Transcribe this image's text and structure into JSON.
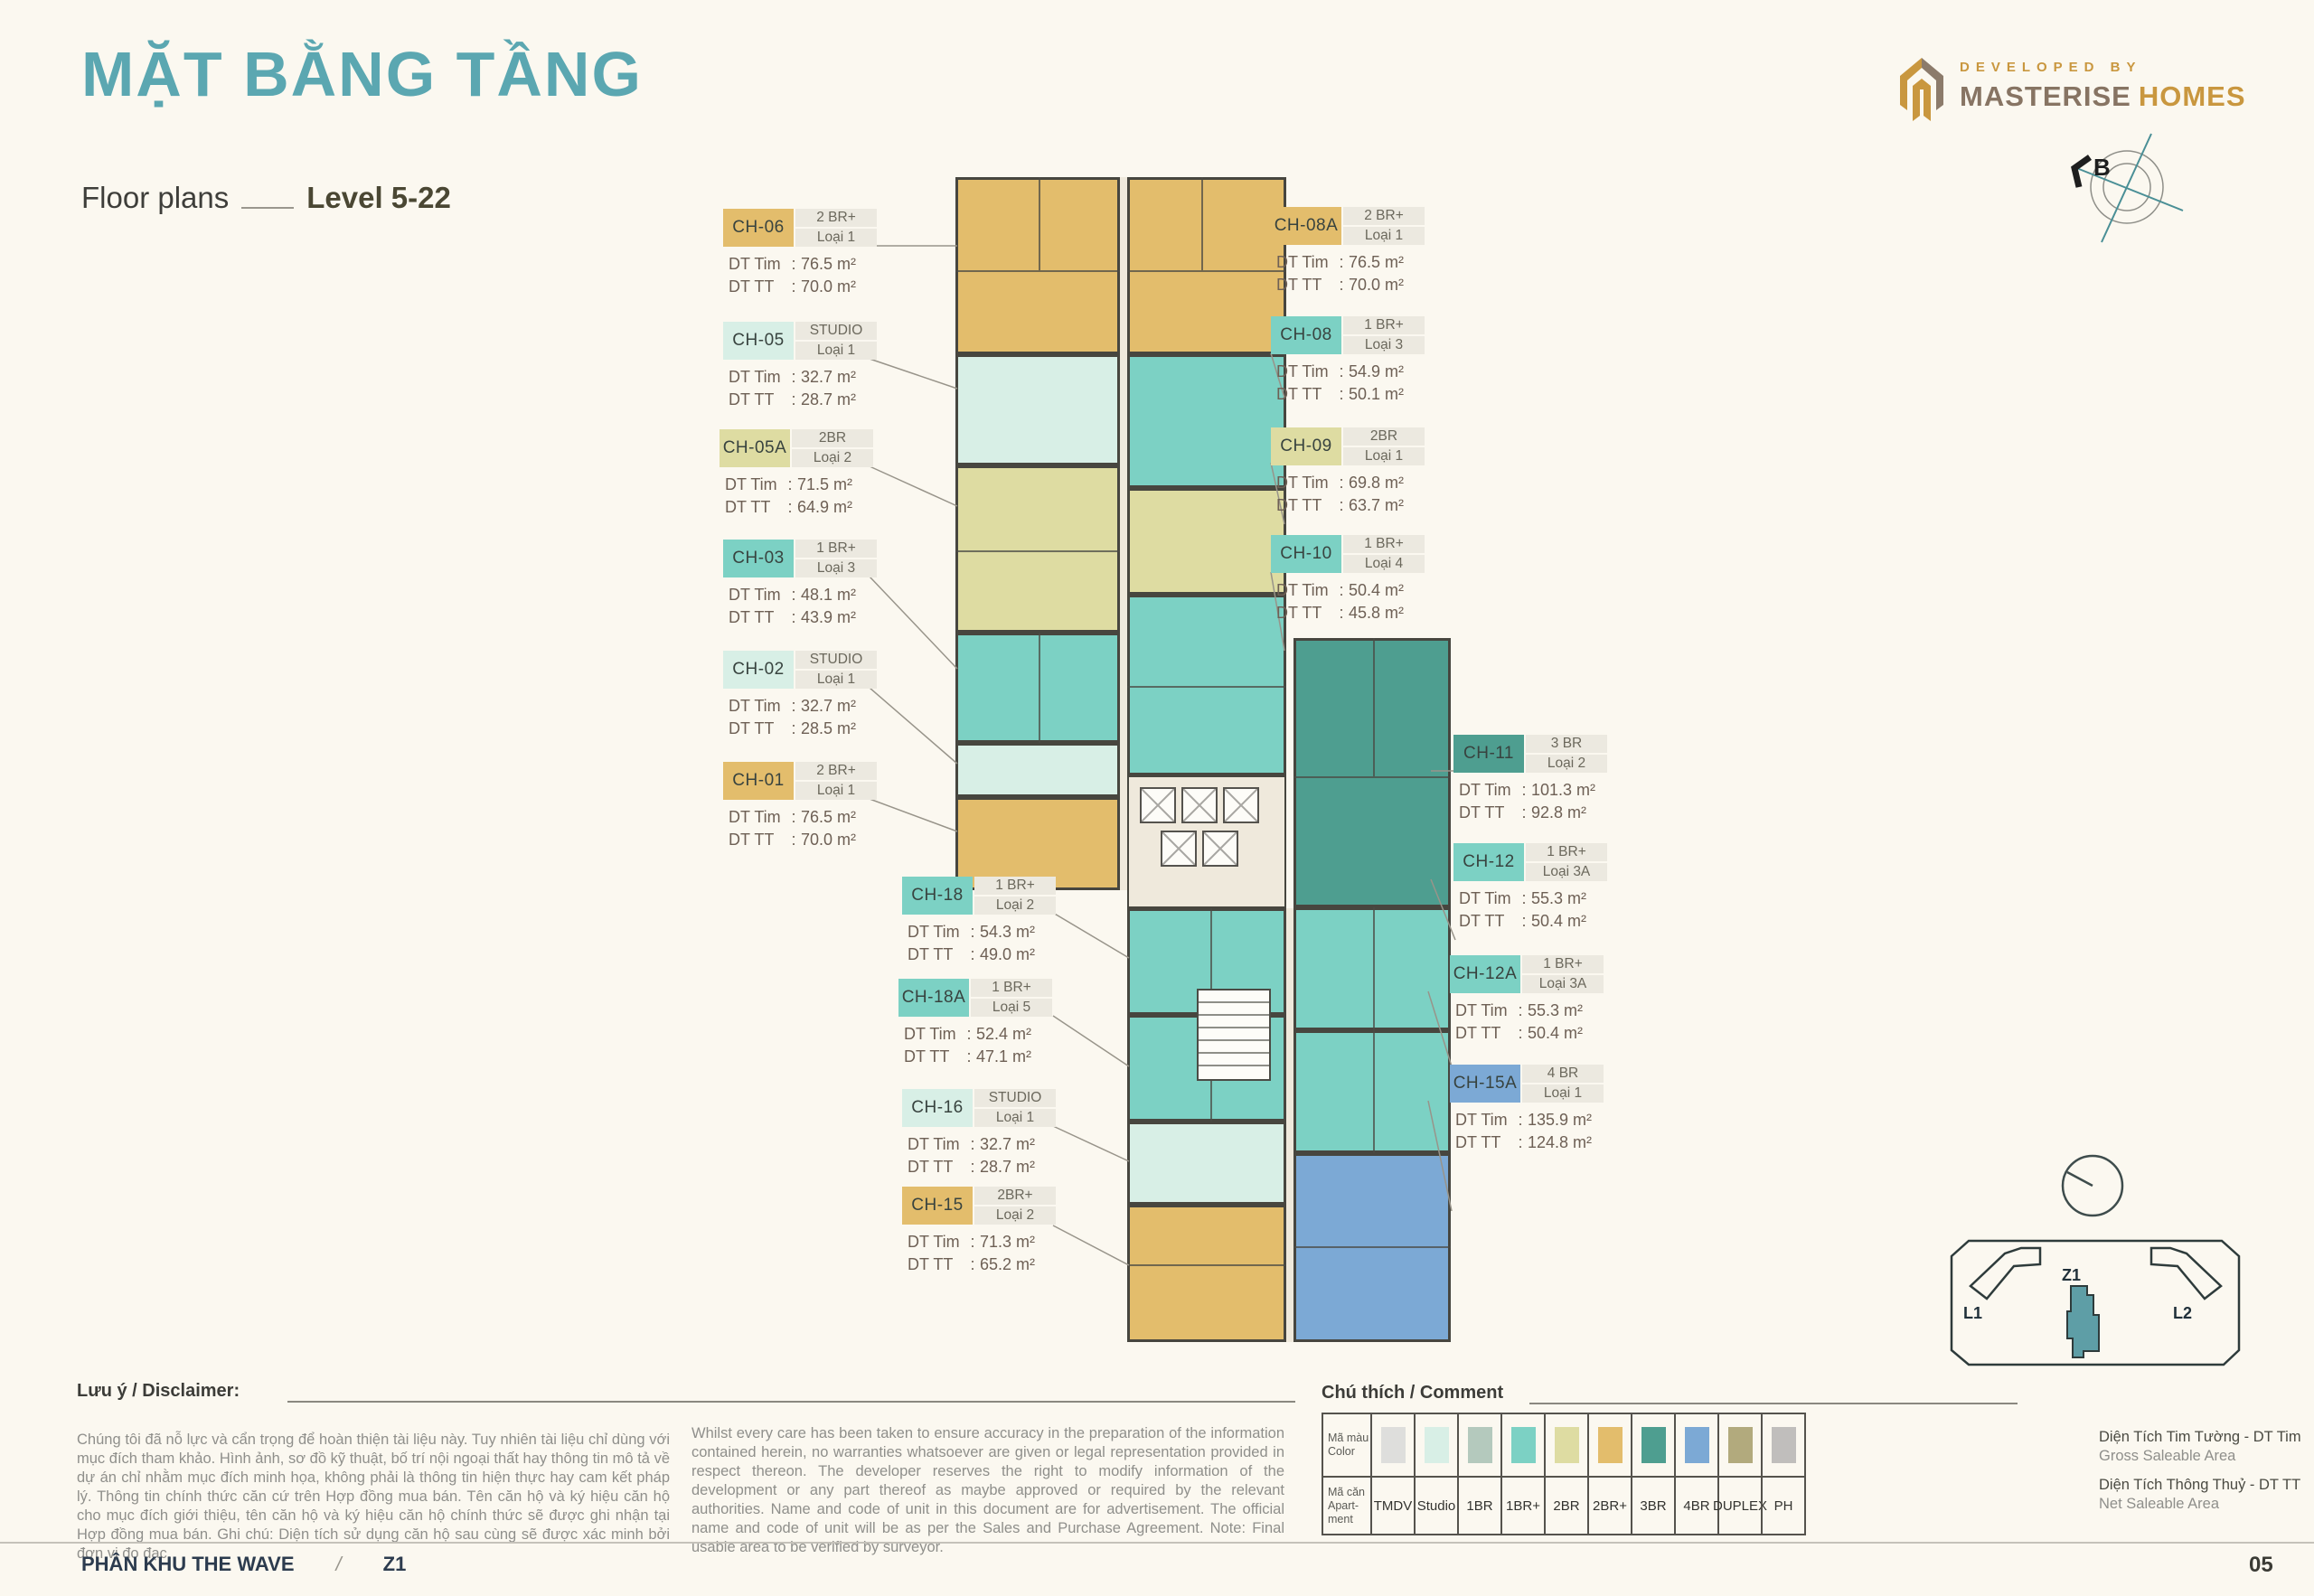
{
  "header": {
    "title": "MẶT BẰNG TẦNG",
    "subtitle": "Floor plans",
    "level": "Level 5-22"
  },
  "logo": {
    "developed_by": "DEVELOPED BY",
    "brand_primary": "MASTERISE",
    "brand_secondary": "HOMES"
  },
  "compass": {
    "north_label": "B"
  },
  "area_labels": {
    "dt_tim": "DT Tim",
    "dt_tt": "DT TT"
  },
  "units": [
    {
      "code": "CH-06",
      "type": "2 BR+",
      "variant": "Loại 1",
      "dt_tim": "76.5 m²",
      "dt_tt": "70.0 m²",
      "color_key": "2BR+"
    },
    {
      "code": "CH-05",
      "type": "STUDIO",
      "variant": "Loại 1",
      "dt_tim": "32.7 m²",
      "dt_tt": "28.7 m²",
      "color_key": "Studio"
    },
    {
      "code": "CH-05A",
      "type": "2BR",
      "variant": "Loại 2",
      "dt_tim": "71.5 m²",
      "dt_tt": "64.9 m²",
      "color_key": "2BR"
    },
    {
      "code": "CH-03",
      "type": "1 BR+",
      "variant": "Loại 3",
      "dt_tim": "48.1 m²",
      "dt_tt": "43.9 m²",
      "color_key": "1BR+"
    },
    {
      "code": "CH-02",
      "type": "STUDIO",
      "variant": "Loại 1",
      "dt_tim": "32.7 m²",
      "dt_tt": "28.5 m²",
      "color_key": "Studio"
    },
    {
      "code": "CH-01",
      "type": "2 BR+",
      "variant": "Loại 1",
      "dt_tim": "76.5 m²",
      "dt_tt": "70.0 m²",
      "color_key": "2BR+"
    },
    {
      "code": "CH-08A",
      "type": "2 BR+",
      "variant": "Loại 1",
      "dt_tim": "76.5 m²",
      "dt_tt": "70.0 m²",
      "color_key": "2BR+"
    },
    {
      "code": "CH-08",
      "type": "1 BR+",
      "variant": "Loại 3",
      "dt_tim": "54.9 m²",
      "dt_tt": "50.1 m²",
      "color_key": "1BR+"
    },
    {
      "code": "CH-09",
      "type": "2BR",
      "variant": "Loại 1",
      "dt_tim": "69.8 m²",
      "dt_tt": "63.7 m²",
      "color_key": "2BR"
    },
    {
      "code": "CH-10",
      "type": "1 BR+",
      "variant": "Loại 4",
      "dt_tim": "50.4 m²",
      "dt_tt": "45.8 m²",
      "color_key": "1BR+"
    },
    {
      "code": "CH-11",
      "type": "3 BR",
      "variant": "Loại 2",
      "dt_tim": "101.3 m²",
      "dt_tt": "92.8 m²",
      "color_key": "3BR"
    },
    {
      "code": "CH-12",
      "type": "1 BR+",
      "variant": "Loại 3A",
      "dt_tim": "55.3 m²",
      "dt_tt": "50.4 m²",
      "color_key": "1BR+"
    },
    {
      "code": "CH-12A",
      "type": "1 BR+",
      "variant": "Loại 3A",
      "dt_tim": "55.3 m²",
      "dt_tt": "50.4 m²",
      "color_key": "1BR+"
    },
    {
      "code": "CH-15A",
      "type": "4 BR",
      "variant": "Loại 1",
      "dt_tim": "135.9 m²",
      "dt_tt": "124.8 m²",
      "color_key": "4BR"
    },
    {
      "code": "CH-18",
      "type": "1 BR+",
      "variant": "Loại 2",
      "dt_tim": "54.3 m²",
      "dt_tt": "49.0 m²",
      "color_key": "1BR+"
    },
    {
      "code": "CH-18A",
      "type": "1 BR+",
      "variant": "Loại 5",
      "dt_tim": "52.4 m²",
      "dt_tt": "47.1 m²",
      "color_key": "1BR+"
    },
    {
      "code": "CH-16",
      "type": "STUDIO",
      "variant": "Loại 1",
      "dt_tim": "32.7 m²",
      "dt_tt": "28.7 m²",
      "color_key": "Studio"
    },
    {
      "code": "CH-15",
      "type": "2BR+",
      "variant": "Loại 2",
      "dt_tim": "71.3 m²",
      "dt_tt": "65.2 m²",
      "color_key": "2BR+"
    }
  ],
  "legend": {
    "heading": "Chú thích / Comment",
    "row1_vi": "Mã màu",
    "row1_en": "Color",
    "row2_vi": "Mã căn",
    "row2_en": "Apart-",
    "row2_en2": "ment",
    "items": [
      {
        "label": "TMDV",
        "color": "#DEDEDC"
      },
      {
        "label": "Studio",
        "color": "#D8EFE6"
      },
      {
        "label": "1BR",
        "color": "#B4C9BD"
      },
      {
        "label": "1BR+",
        "color": "#7CD1C4"
      },
      {
        "label": "2BR",
        "color": "#DEDCA2"
      },
      {
        "label": "2BR+",
        "color": "#E3BD6C"
      },
      {
        "label": "3BR",
        "color": "#4E9E90"
      },
      {
        "label": "4BR",
        "color": "#7CA9D5"
      },
      {
        "label": "DUPLEX",
        "color": "#B2AA7D"
      },
      {
        "label": "PH",
        "color": "#C0BEBC"
      }
    ]
  },
  "plan_colors": {
    "corridor": "#EFE9DC",
    "wall": "#47463F"
  },
  "area_definitions": [
    {
      "vi": "Diện Tích Tim Tường - DT Tim",
      "en": "Gross Saleable Area"
    },
    {
      "vi": "Diện Tích Thông Thuỷ - DT TT",
      "en": "Net Saleable Area"
    }
  ],
  "disclaimer": {
    "heading": "Lưu ý / Disclaimer:",
    "vi": "Chúng tôi đã nỗ lực và cẩn trọng để hoàn thiện tài liệu này. Tuy nhiên tài liệu chỉ dùng với mục đích tham khảo. Hình ảnh, sơ đồ kỹ thuật, bố trí nội ngoại thất hay thông tin mô tả về dự án chỉ nhằm mục đích minh họa, không phải là thông tin hiện thực hay cam kết pháp lý. Thông tin chính thức căn cứ trên Hợp đồng mua bán. Tên căn hộ và ký hiệu căn hộ cho mục đích giới thiệu, tên căn hộ và ký hiệu căn hộ chính thức sẽ được ghi nhận tại Hợp đồng mua bán. Ghi chú: Diện tích sử dụng căn hộ sau cùng sẽ được xác minh bởi đơn vị đo đạc.",
    "en": "Whilst every care has been taken to ensure accuracy in the preparation of the information contained herein, no warranties whatsoever are given or legal representation provided in respect thereon. The developer reserves the right to modify information of the development or any part thereof as maybe approved or required by the relevant authorities. Name and code of unit in this document are for advertisement. The official name and code of unit will be as per the Sales and Purchase Agreement. Note: Final usable area to be verified by surveyor."
  },
  "site_map": {
    "zone": "Z1",
    "left": "L1",
    "right": "L2"
  },
  "footer": {
    "left": "PHÂN KHU THE WAVE",
    "separator": "/",
    "zone": "Z1",
    "page": "05"
  }
}
